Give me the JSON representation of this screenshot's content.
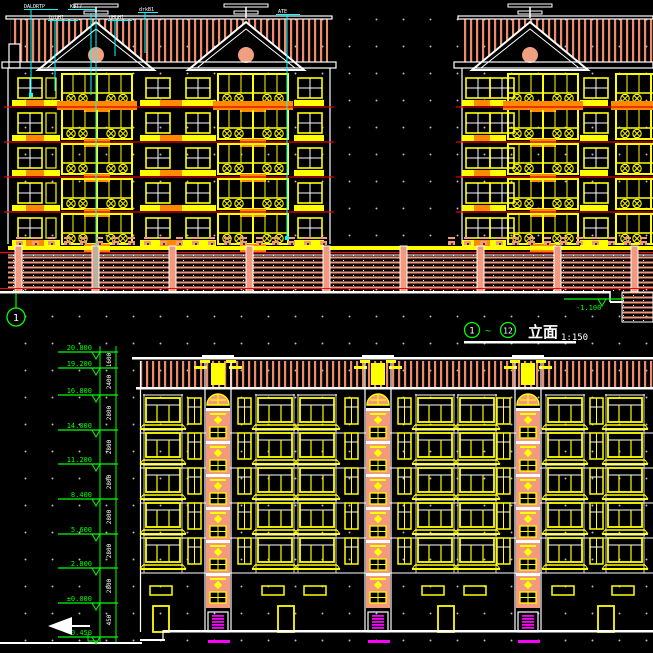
{
  "title_block": {
    "bubble_start": "1",
    "range_symbol": "~",
    "bubble_end": "12",
    "title": "立面",
    "scale": "1:150"
  },
  "top_elevation": {
    "grid_bubble": "1",
    "ground_level_label": "-1.100",
    "annotations": [
      "DALDRTP",
      "KBT7",
      "brbH1",
      "dHbH1",
      "drkB1",
      "ATE"
    ]
  },
  "bottom_elevation": {
    "levels": [
      "20.800",
      "19.200",
      "16.800",
      "14.000",
      "11.200",
      "8.400",
      "5.600",
      "2.800",
      "±0.000",
      "-0.450"
    ],
    "dims": [
      "1600",
      "2400",
      "2800",
      "2800",
      "2800",
      "2800",
      "2800",
      "2800",
      "450"
    ]
  },
  "colors": {
    "background": "#000000",
    "roof_hatch": "#F08A6A",
    "salmon_fill": "#F2997E",
    "window_yellow": "#FFFF00",
    "accent_orange": "#FF8A00",
    "floor_line_red": "#E00000",
    "leader_cyan": "#00FFFF",
    "dimension_green": "#00FF00",
    "door_magenta": "#FF00FF",
    "line_white": "#FFFFFF"
  }
}
